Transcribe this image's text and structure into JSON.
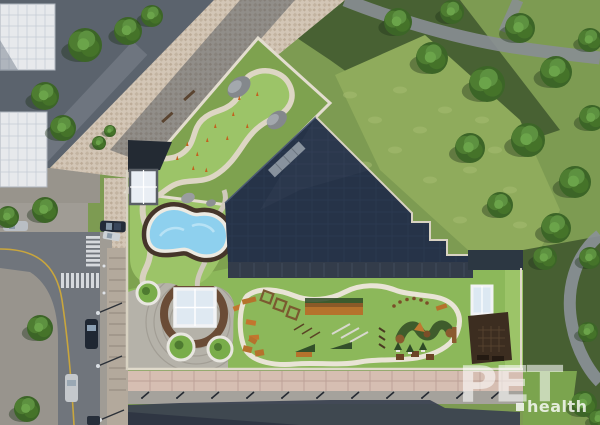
{
  "watermark": {
    "brand": "PET",
    "sub": "health"
  },
  "palette": {
    "watermark": "#ffffff",
    "lawn": "#8cb85a",
    "lawn_bright": "#9cc468",
    "garden_base": "#7ea24f",
    "park": "#7d9b52",
    "park_shadow": "#3b522c",
    "roof": "#263348",
    "pool_water": "#8ed0ee",
    "path_cream": "#ddd6c4",
    "cobble": "#d3c6b6",
    "asphalt": "#5b636d",
    "road": "#70757c",
    "sidewalk_pink": "#d6beb2",
    "deck_brown": "#3c2d20",
    "equipment_orange": "#b5722c",
    "building_white": "#e7e9ec",
    "road_line_yellow": "#c9a63d",
    "shadow": "#3a4150"
  },
  "scene": {
    "park_trees": [
      [
        398,
        22,
        14
      ],
      [
        432,
        58,
        16
      ],
      [
        452,
        12,
        12
      ],
      [
        487,
        84,
        18
      ],
      [
        520,
        28,
        15
      ],
      [
        556,
        72,
        16
      ],
      [
        590,
        40,
        12
      ],
      [
        470,
        148,
        15
      ],
      [
        528,
        140,
        17
      ],
      [
        575,
        182,
        16
      ],
      [
        500,
        205,
        13
      ],
      [
        556,
        228,
        15
      ],
      [
        592,
        118,
        13
      ],
      [
        545,
        258,
        12
      ],
      [
        590,
        258,
        11
      ],
      [
        588,
        332,
        10
      ],
      [
        584,
        404,
        13
      ],
      [
        599,
        419,
        10
      ]
    ],
    "street_trees": [
      [
        85,
        45,
        17
      ],
      [
        128,
        31,
        14
      ],
      [
        45,
        96,
        14
      ],
      [
        63,
        128,
        13
      ],
      [
        152,
        16,
        11
      ],
      [
        45,
        210,
        13
      ],
      [
        8,
        217,
        11
      ],
      [
        40,
        328,
        13
      ],
      [
        27,
        409,
        13
      ],
      [
        99,
        143,
        7
      ],
      [
        110,
        131,
        6
      ]
    ],
    "garden_markers": [
      [
        165,
        150
      ],
      [
        176,
        160
      ],
      [
        186,
        146
      ],
      [
        196,
        156
      ],
      [
        206,
        142
      ],
      [
        192,
        170
      ],
      [
        214,
        128
      ],
      [
        226,
        140
      ],
      [
        232,
        116
      ],
      [
        246,
        128
      ],
      [
        205,
        172
      ],
      [
        157,
        168
      ],
      [
        238,
        100
      ],
      [
        256,
        96
      ]
    ],
    "bike_rack_xs": [
      142,
      177,
      212,
      247,
      282,
      317,
      352,
      387,
      422,
      457,
      492
    ],
    "bike_rack_y": 394,
    "crosswalk_a": {
      "x": 86,
      "w": 18,
      "y0": 236,
      "step": 4.6,
      "h": 2.8,
      "count": 7
    },
    "crosswalk_b": {
      "y": 273,
      "h": 15,
      "x0": 61,
      "step": 5,
      "w": 3,
      "count": 8
    },
    "mottle": [
      [
        350,
        95
      ],
      [
        375,
        120
      ],
      [
        400,
        90
      ],
      [
        420,
        130
      ],
      [
        445,
        110
      ],
      [
        470,
        170
      ],
      [
        430,
        180
      ],
      [
        495,
        150
      ],
      [
        510,
        190
      ],
      [
        460,
        220
      ],
      [
        520,
        225
      ],
      [
        395,
        150
      ],
      [
        365,
        165
      ],
      [
        482,
        120
      ]
    ]
  }
}
